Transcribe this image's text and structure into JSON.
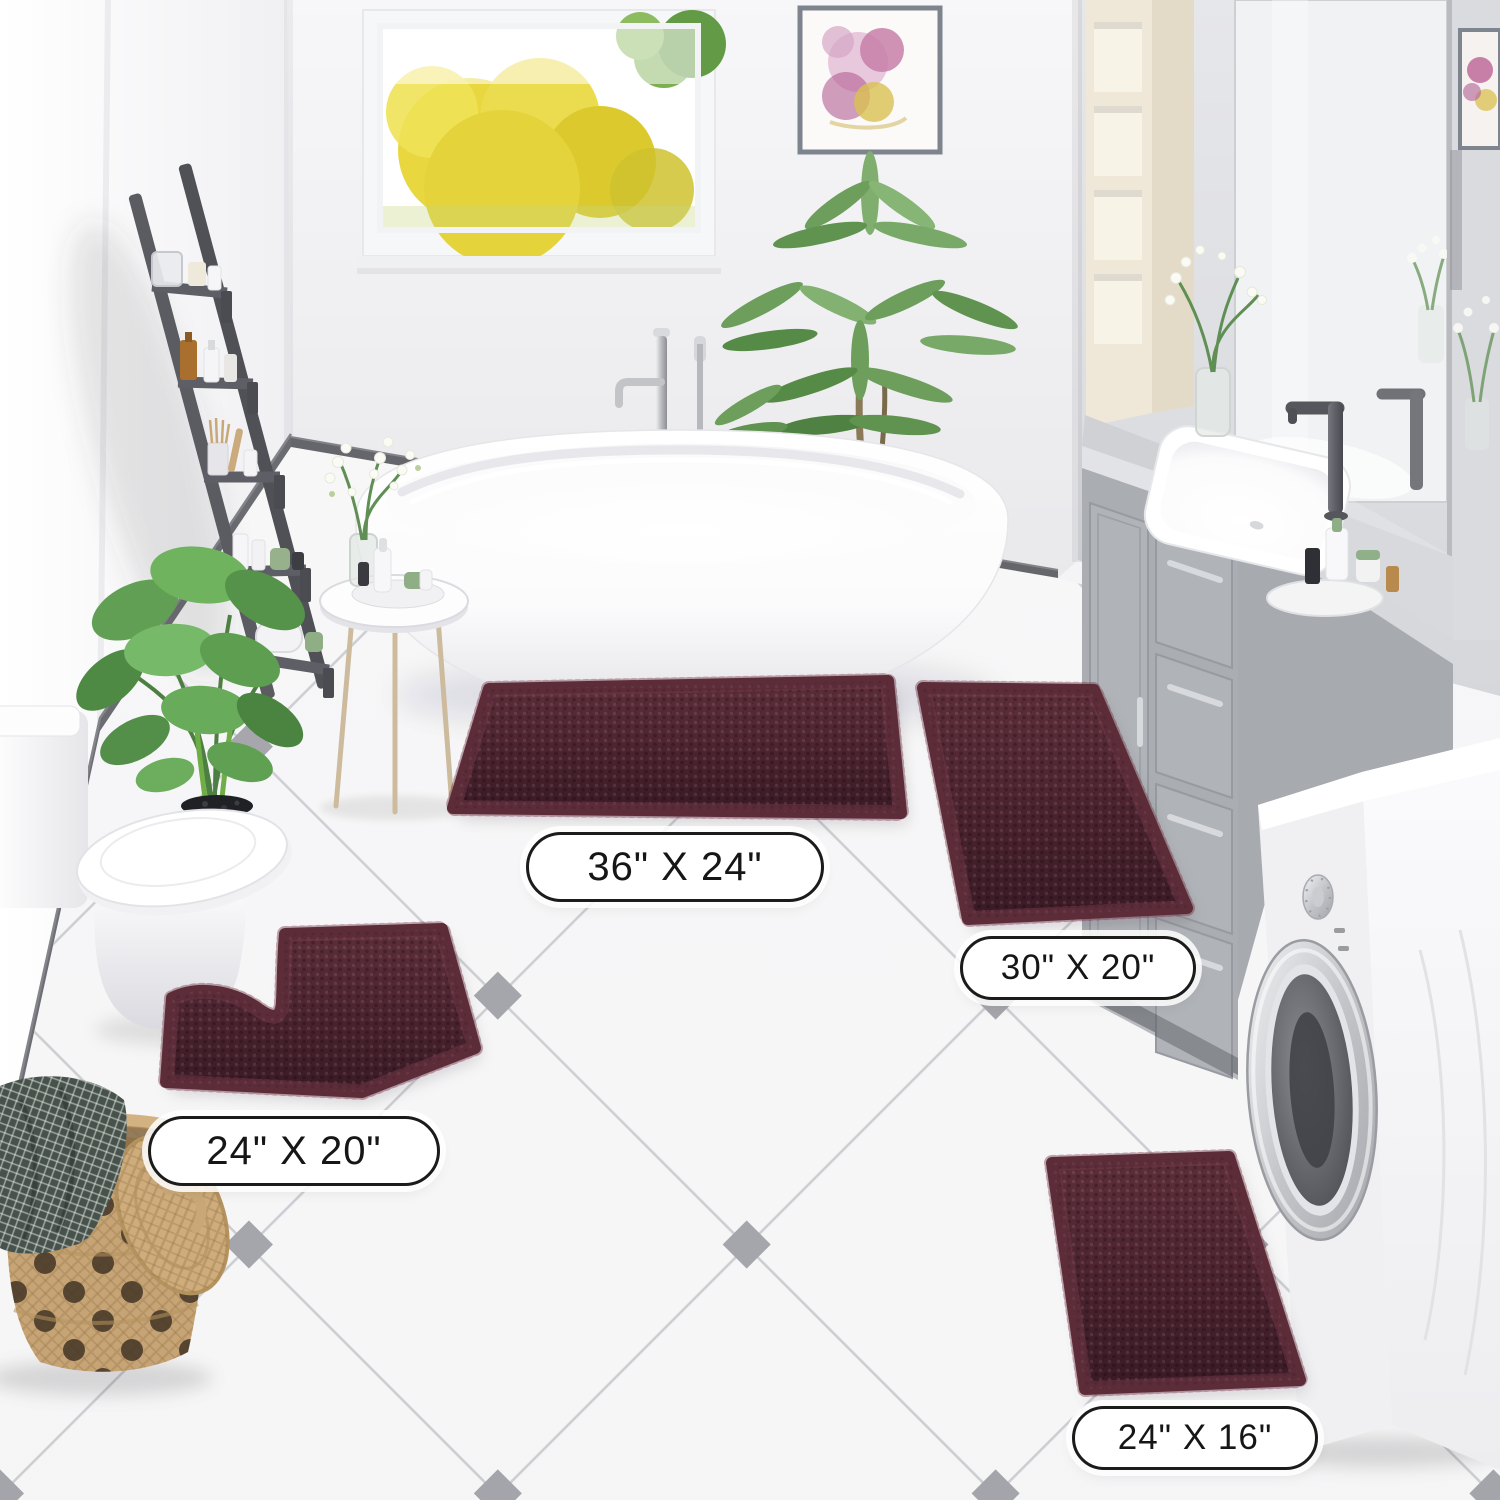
{
  "scene": {
    "mat_count": 4,
    "mat_color_hex": "#4e2531"
  },
  "size_labels": {
    "large_rect": "36\" X 24\"",
    "medium_rect": "30\" X 20\"",
    "contour": "24\" X 20\"",
    "small_rect": "24\" X 16\""
  },
  "palette": {
    "wall_light": "#f6f6f8",
    "wall_gray": "#dfe0e3",
    "baseboard": "#64656b",
    "floor_tile_line": "#c9cacf",
    "floor_accent_diamond": "#9b9ca2",
    "mat_burgundy": "#4e2531",
    "vanity_gray": "#b2b5ba",
    "cabinet_cream": "#efe8d9",
    "ladder_gray": "#595a60",
    "plant_green": "#6fae60",
    "basket_tan": "#c7a476"
  }
}
